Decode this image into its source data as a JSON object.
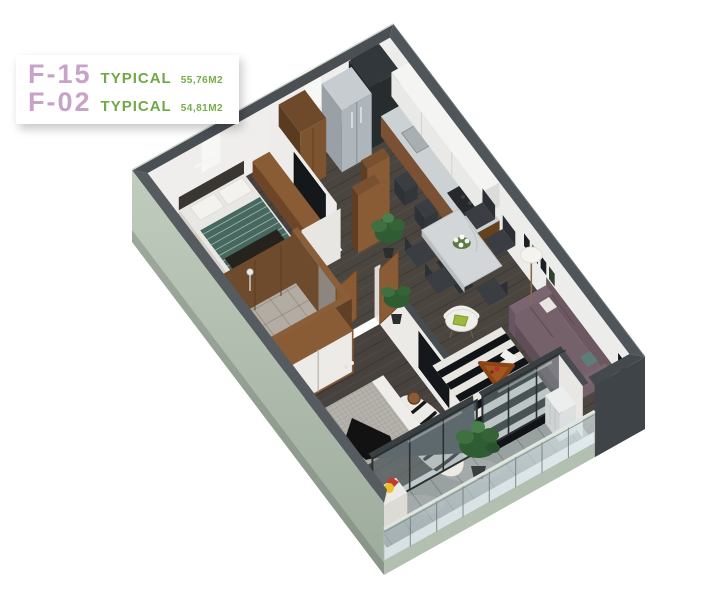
{
  "legend": {
    "units": [
      {
        "code": "F-15",
        "label": "TYPICAL",
        "area": "55,76M2"
      },
      {
        "code": "F-02",
        "label": "TYPICAL",
        "area": "54,81M2"
      }
    ]
  },
  "palette": {
    "unit_code_purple": "#c7a3c9",
    "typical_green": "#6ea943",
    "wall_top_gray": "#50555a",
    "outer_wall_sage": "#b7c3b5",
    "wood_floor": "#4b4540",
    "wood_furniture": "#8a5c36",
    "marble": "#d3d6d8",
    "sofa_mauve": "#74616a",
    "plant_green": "#2f5d33",
    "bath_tile": "#b3aca2",
    "balcony_tile": "#9aa1a1"
  }
}
